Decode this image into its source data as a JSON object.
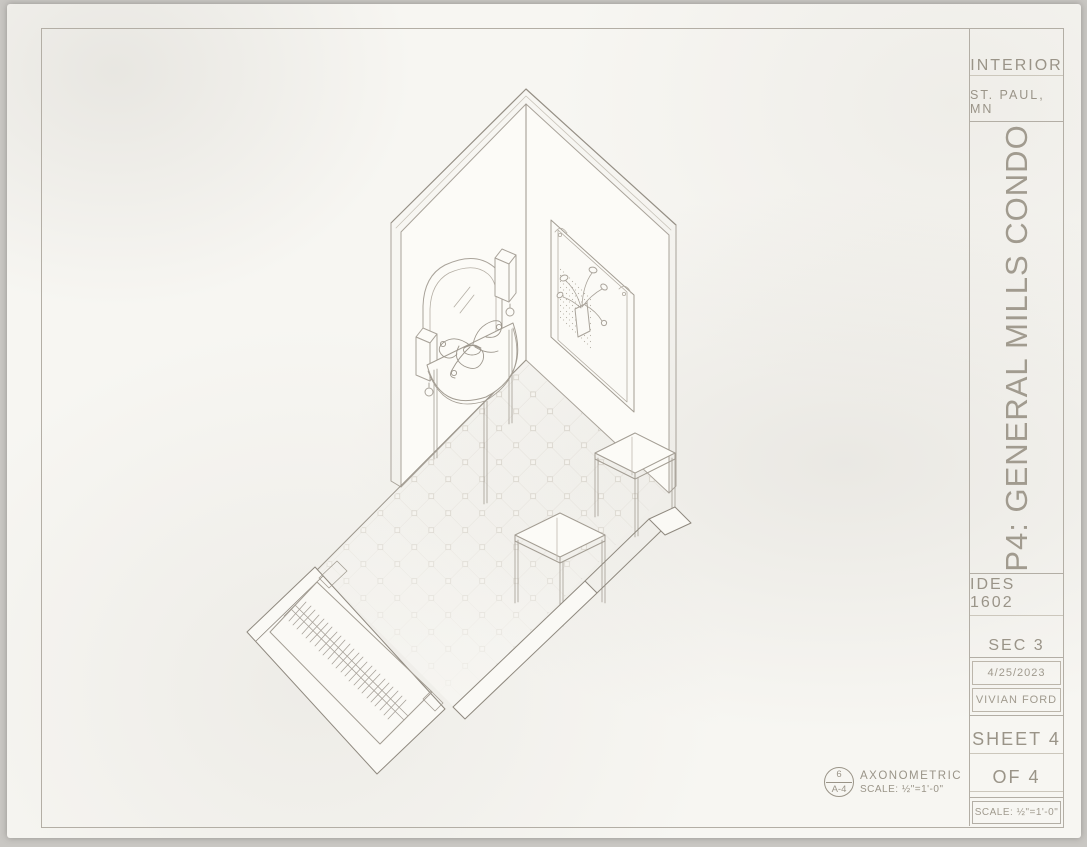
{
  "sheet": {
    "paper_color": "#f7f6f2",
    "pencil_line_color": "#a8a29a",
    "pencil_text_color": "#9a9488"
  },
  "title_block": {
    "project_type": "INTERIOR",
    "location": "ST. PAUL, MN",
    "project_title": "P4: GENERAL MILLS CONDO",
    "course": "IDES 1602",
    "section": "SEC 3",
    "date": "4/25/2023",
    "author": "VIVIAN FORD",
    "sheet_number": "SHEET 4",
    "sheet_of": "OF 4",
    "scale": "SCALE: ½\"=1'-0\""
  },
  "callout": {
    "detail_number": "6",
    "sheet_reference": "A-4",
    "view_name": "AXONOMETRIC",
    "view_scale": "SCALE: ½\"=1'-0\""
  },
  "drawing": {
    "view_type": "axonometric-interior",
    "elements": [
      "corner-walls",
      "arched-mirror",
      "wall-sconce-left",
      "wall-sconce-right",
      "framed-botanical-artwork",
      "demilune-console-table",
      "orchid-plant",
      "diamond-tile-floor",
      "square-stool-front",
      "square-stool-back",
      "low-wall-band",
      "entry-door-with-hatched-threshold"
    ]
  }
}
